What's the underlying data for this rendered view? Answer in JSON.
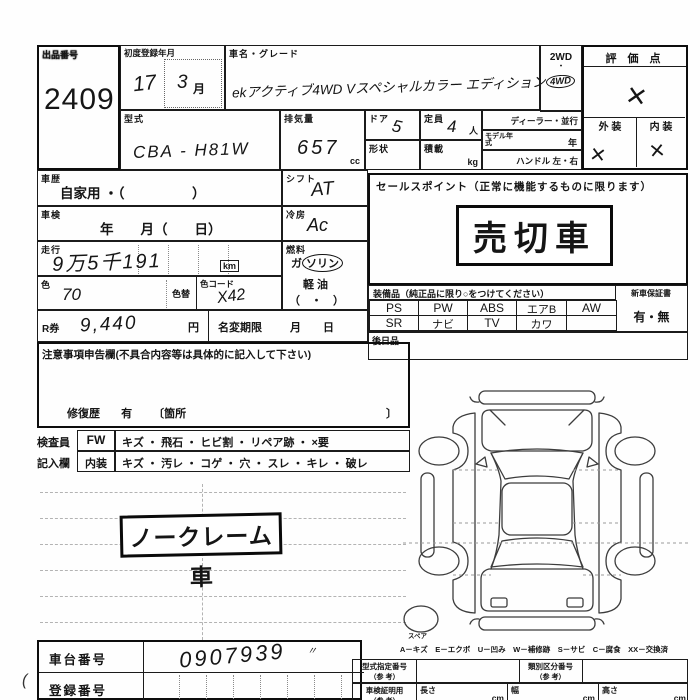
{
  "header": {
    "lot_label": "出品番号",
    "lot_number": "2409",
    "first_reg_label": "初度登録年月",
    "first_reg_year": "17",
    "first_reg_month": "3",
    "month_unit": "月",
    "car_name_label": "車名・グレード",
    "car_name_value": "ekアクティブ4WD Vスペシャルカラー エディション",
    "drive_2wd": "2WD",
    "drive_dot": "・",
    "drive_4wd": "4WD",
    "score_label": "評 価 点",
    "score_mark": "×",
    "exterior_label": "外 装",
    "interior_label": "内 装",
    "exterior_mark": "×",
    "interior_mark": "×"
  },
  "specs": {
    "model_label": "型式",
    "model_value": "CBA - H81W",
    "displacement_label": "排気量",
    "displacement_value": "657",
    "displacement_unit": "cc",
    "doors_label": "ドア",
    "doors_value": "5",
    "shape_label": "形状",
    "capacity_label": "定員",
    "capacity_value": "4",
    "capacity_unit": "人",
    "load_label": "積載",
    "load_unit": "kg",
    "dealer_label": "ディーラー・並行",
    "model_year_label": "モデル年式",
    "model_year_unit": "年",
    "handle_label": "ハンドル 左・右"
  },
  "details": {
    "history_label": "車歴",
    "history_value": "自家用 ・（　　　　　）",
    "shaken_label": "車検",
    "shaken_value": "年　　月（　　日）",
    "mileage_label": "走行",
    "mileage_value": "9万5千191",
    "mileage_unit": "km",
    "color_label": "色",
    "color_value": "70",
    "color_change_label": "色替",
    "color_code_label": "色コード",
    "color_code_value": "X42",
    "shift_label": "シフト",
    "shift_value": "AT",
    "ac_label": "冷房",
    "ac_value": "Ac",
    "fuel_label": "燃料",
    "fuel_gas_prefix": "ガ",
    "fuel_gas_circled": "ソリン",
    "fuel_diesel": "軽 油",
    "fuel_paren": "（　・　）",
    "rticket_label": "R券",
    "rticket_value": "9,440",
    "rticket_unit": "円",
    "name_change_label": "名変期限",
    "name_change_value": "月　　日"
  },
  "sales": {
    "header": "セールスポイント（正常に機能するものに限ります）",
    "stamp": "売切車"
  },
  "equipment": {
    "header": "装備品（純正品に限り○をつけてください）",
    "warranty_label": "新車保証書",
    "warranty_value": "有・無",
    "row1": [
      "PS",
      "PW",
      "ABS",
      "エアB",
      "AW"
    ],
    "row2": [
      "SR",
      "ナビ",
      "TV",
      "カワ",
      ""
    ],
    "later_label": "後日品"
  },
  "notes": {
    "header": "注意事項申告欄(不具合内容等は具体的に記入して下さい)",
    "repair_label": "修復歴",
    "repair_value": "有",
    "repair_open": "〔箇所",
    "repair_close": "〕",
    "inspector_row1_label": "検査員",
    "inspector_row2_label": "記入欄",
    "fw_label": "FW",
    "fw_items": "キズ ・ 飛石 ・ ヒビ割 ・ リペア跡 ・ ×要",
    "interior_label": "内装",
    "interior_items": "キズ ・ 汚レ ・ コゲ ・ 穴 ・ スレ ・ キレ ・ 破レ",
    "noclaim_stamp": "ノークレーム車"
  },
  "diagram": {
    "spare_label": "スペア",
    "legend": "A－キズ　E－エクボ　U－凹み　W－補修跡　S－サビ　C－腐食　XX－交換済"
  },
  "bottom": {
    "chassis_label": "車台番号",
    "chassis_value": "0907939",
    "chassis_ditto": "〃",
    "reg_label": "登録番号",
    "type_designation_label": "型式指定番号",
    "ref_label": "（参 考）",
    "class_label": "類別区分番号",
    "cert_label": "車検証明用",
    "length_label": "長さ",
    "width_label": "幅",
    "height_label": "高さ",
    "cm_unit": "cm"
  }
}
